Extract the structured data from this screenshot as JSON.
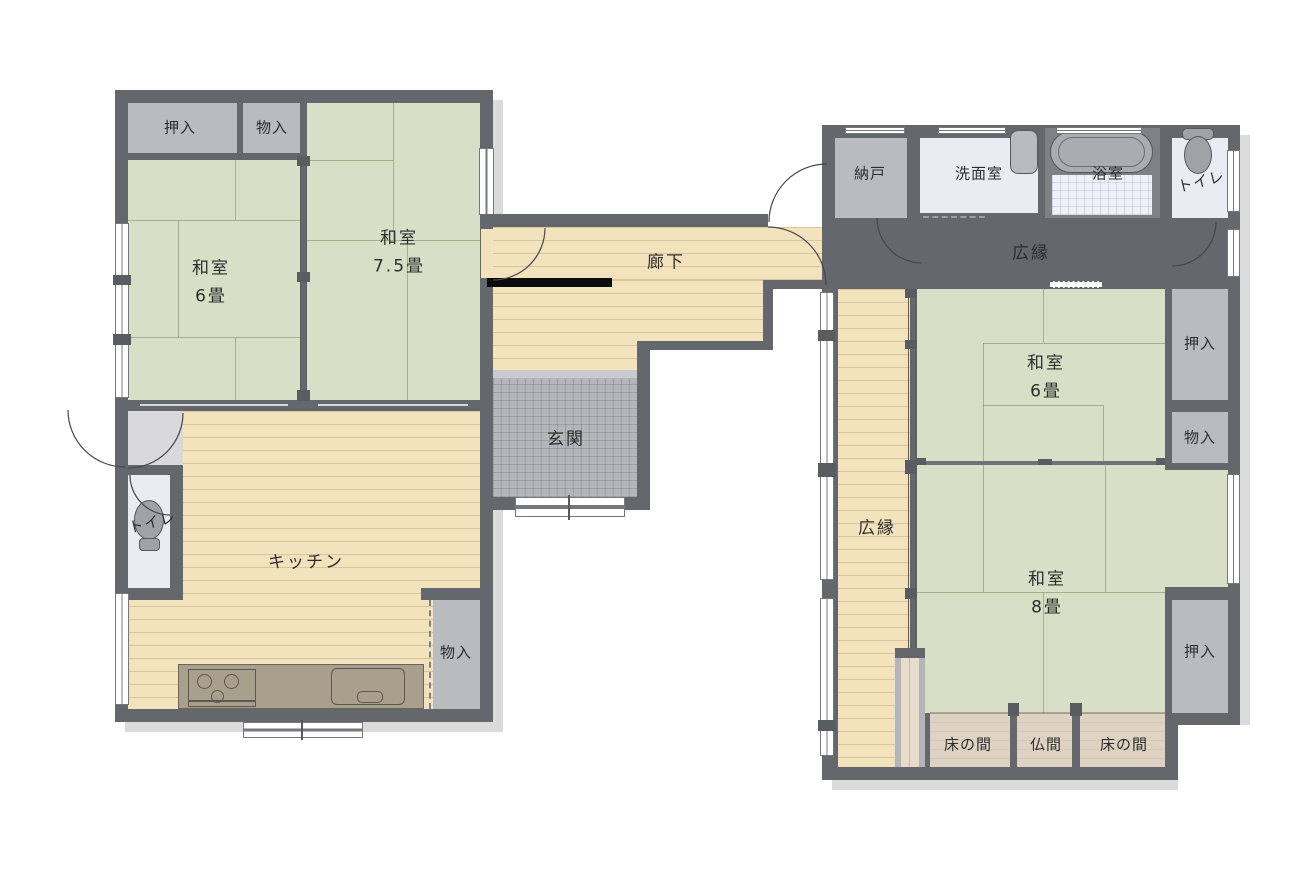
{
  "plan_title": "house-floor-plan",
  "colors": {
    "wall": "#64676c",
    "tatami": "#d8dfc6",
    "wood_floor": "#f2e3bd",
    "closet": "#babbc1",
    "genkan_tile": "#b5b6ba",
    "wet_room_floor": "#eaecf4",
    "tokonoma": "#ded3c3",
    "counter": "#a89f8d",
    "step_bar": "#0b0b0b"
  },
  "labels": {
    "oshiire_top_left": "押入",
    "monoire_top_left": "物入",
    "washitsu_75_name": "和室",
    "washitsu_75_size": "7.5畳",
    "washitsu_6_left_name": "和室",
    "washitsu_6_left_size": "6畳",
    "rouka": "廊下",
    "genkan": "玄関",
    "kitchen": "キッチン",
    "toilet_left": "トイレ",
    "monoire_kitchen": "物入",
    "nando": "納戸",
    "senmenshitsu": "洗面室",
    "yokushitsu": "浴室",
    "toilet_right": "トイレ",
    "hiroen_top": "広縁",
    "hiroen_side": "広縁",
    "washitsu_6_right_name": "和室",
    "washitsu_6_right_size": "6畳",
    "washitsu_8_name": "和室",
    "washitsu_8_size": "8畳",
    "oshiire_right_top": "押入",
    "monoire_right": "物入",
    "oshiire_right_bottom": "押入",
    "tokonoma_left": "床の間",
    "butsuma": "仏間",
    "tokonoma_right": "床の間"
  }
}
